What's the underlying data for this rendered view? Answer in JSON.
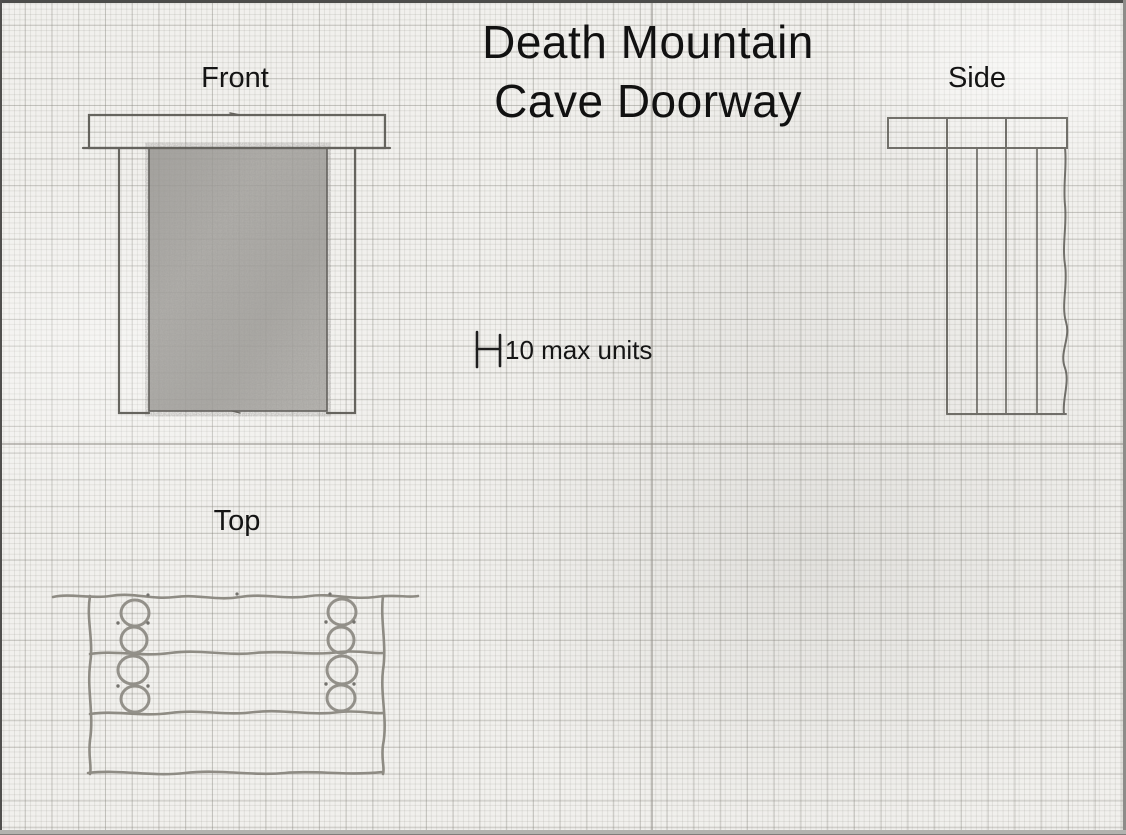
{
  "title": {
    "line1": "Death Mountain",
    "line2": "Cave Doorway"
  },
  "views": {
    "front": {
      "label": "Front",
      "description": "front elevation: lintel slab over two posts with pencil-shaded doorway opening"
    },
    "side": {
      "label": "Side",
      "description": "side elevation: lintel slab over stacked vertical planks with rough right edge"
    },
    "top": {
      "label": "Top",
      "description": "top plan: three rough log courses with two columns of stacked rings"
    }
  },
  "scale": {
    "label": "10 max units",
    "units": 10
  },
  "colors": {
    "paper": "#f1f0ed",
    "grid_minor": "#dddcd8",
    "grid_major": "#c2c1bc",
    "pencil_dark": "#57554f",
    "pencil_sketch": "#8a877f",
    "doorway_shading": "#a3a19c",
    "ink_text": "#141414"
  }
}
